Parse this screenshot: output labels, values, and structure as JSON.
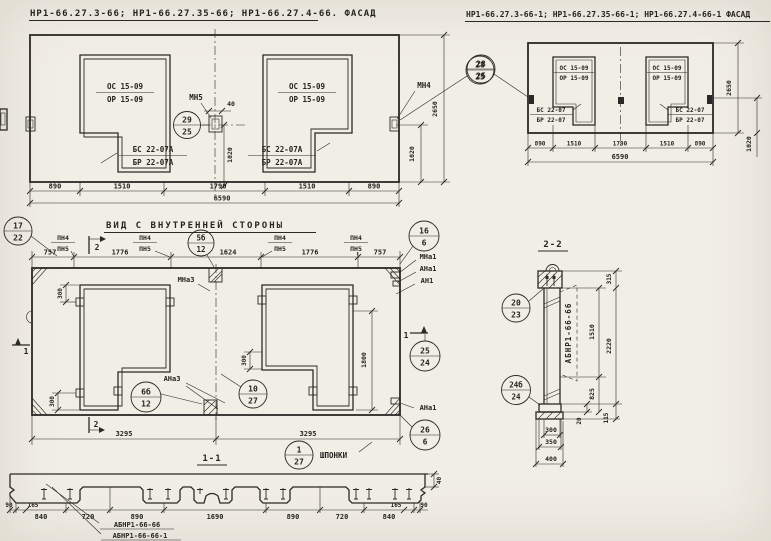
{
  "colors": {
    "paper": "#f1eee6",
    "ink": "#2b2925"
  },
  "facade_left": {
    "title": "НР1-66.27.3-66; НР1-66.27.35-66; НР1-66.27.4-66. ФАСАД",
    "win_top": "ОС 15-09",
    "win_bot": "ОР 15-09",
    "door_top": "БС 22-07А",
    "door_bot": "БР 22-07А",
    "mn5": "МН5",
    "mn4": "МН4",
    "bubble_mn5": {
      "num": "29",
      "den": "25"
    },
    "bubble_mn4": {
      "num": "28",
      "den": "25"
    },
    "dim_40": "40",
    "dim_1020": "1020",
    "dim_1020_right": "1020",
    "dim_2650": "2650",
    "dims_bottom": [
      "890",
      "1510",
      "1790",
      "1510",
      "890"
    ],
    "dim_total": "6590"
  },
  "facade_right": {
    "title": "НР1-66.27.3-66-1; НР1-66.27.35-66-1; НР1-66.27.4-66-1 ФАСАД",
    "bubble": {
      "num": "28",
      "den": "25"
    },
    "win_top": "ОС 15-09",
    "win_bot": "ОР 15-09",
    "door_top": "БС 22-07",
    "door_bot": "БР 22-07",
    "dims_bottom": [
      "890",
      "1510",
      "1790",
      "1510",
      "890"
    ],
    "dim_total": "6590",
    "dim_2650": "2650",
    "dim_1020": "1020"
  },
  "inner_view": {
    "title": "ВИД С ВНУТРЕННЕЙ СТОРОНЫ",
    "pn4": "ПН4",
    "pn5": "ПН5",
    "mna3": "МНа3",
    "ana3": "АНа3",
    "mna1": "МНа1",
    "ana1": "АНа1",
    "an1": "АН1",
    "shponki": "ШПОНКИ",
    "sec1": "1",
    "sec2": "2",
    "bubbles": {
      "b17": {
        "num": "17",
        "den": "22"
      },
      "b5b": {
        "num": "5б",
        "den": "12"
      },
      "b16": {
        "num": "16",
        "den": "6"
      },
      "b6b": {
        "num": "6б",
        "den": "12"
      },
      "b10": {
        "num": "10",
        "den": "27"
      },
      "b25": {
        "num": "25",
        "den": "24"
      },
      "b26": {
        "num": "26",
        "den": "6"
      },
      "b1": {
        "num": "1",
        "den": "27"
      }
    },
    "dims_top": [
      "757",
      "1776",
      "1624",
      "1776",
      "757"
    ],
    "dim_300": "300",
    "dim_1800": "1800",
    "dim_3295_left": "3295",
    "dim_3295_right": "3295"
  },
  "section_1_1": {
    "title": "1-1",
    "dims": [
      "90",
      "165",
      "840",
      "720",
      "890",
      "1690",
      "890",
      "720",
      "840",
      "165",
      "90"
    ],
    "dim_40": "40",
    "label_a": "АБНР1-66-66",
    "label_b": "АБНР1-66-66-1"
  },
  "section_2_2": {
    "title": "2-2",
    "bubble_top": {
      "num": "20",
      "den": "23"
    },
    "bubble_bottom": {
      "num": "24б",
      "den": "24"
    },
    "label": "АБНР1-66-66",
    "dim_315": "315",
    "dim_1510": "1510",
    "dim_2220": "2220",
    "dim_825": "825",
    "dim_20": "20",
    "dim_115": "115",
    "dim_300": "300",
    "dim_350": "350",
    "dim_400": "400"
  }
}
